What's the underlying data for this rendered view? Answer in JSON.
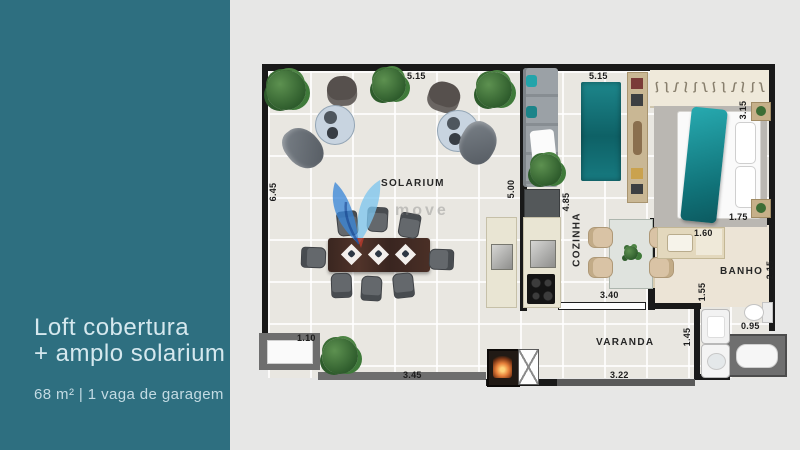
{
  "sidebar": {
    "title_line1": "Loft cobertura",
    "title_line2": "+ amplo solarium",
    "subtitle": "68 m² | 1 vaga de garagem",
    "bg_color": "#2e6f80",
    "title_color": "#d5e8ee"
  },
  "plan": {
    "labels": {
      "solarium": "SOLARIUM",
      "cozinha": "COZINHA",
      "banho": "BANHO",
      "varanda": "VARANDA"
    },
    "dims": {
      "solarium_top": "5.15",
      "solarium_left": "6.45",
      "solarium_right": "5.00",
      "living_top": "5.15",
      "living_left": "4.85",
      "bedroom_right": "3.15",
      "bedroom_bottom": "1.75",
      "banho_vanity": "1.60",
      "banho_right": "2.15",
      "banho_door": "1.55",
      "banho_bottom": "0.95",
      "kitchen_bottom": "3.40",
      "varanda_step": "1.10",
      "varanda_bottom_left": "3.45",
      "varanda_bottom_right": "3.22",
      "varanda_right": "1.45"
    },
    "wardrobe": {
      "hanger_count": 12,
      "hanger_glyph": "ʃ"
    },
    "colors": {
      "wall": "#191919",
      "floor": "#e9e7e1",
      "accent_teal": "#1a9ba1",
      "parapet": "#6e6e6e"
    }
  },
  "watermark": {
    "text": "move"
  }
}
